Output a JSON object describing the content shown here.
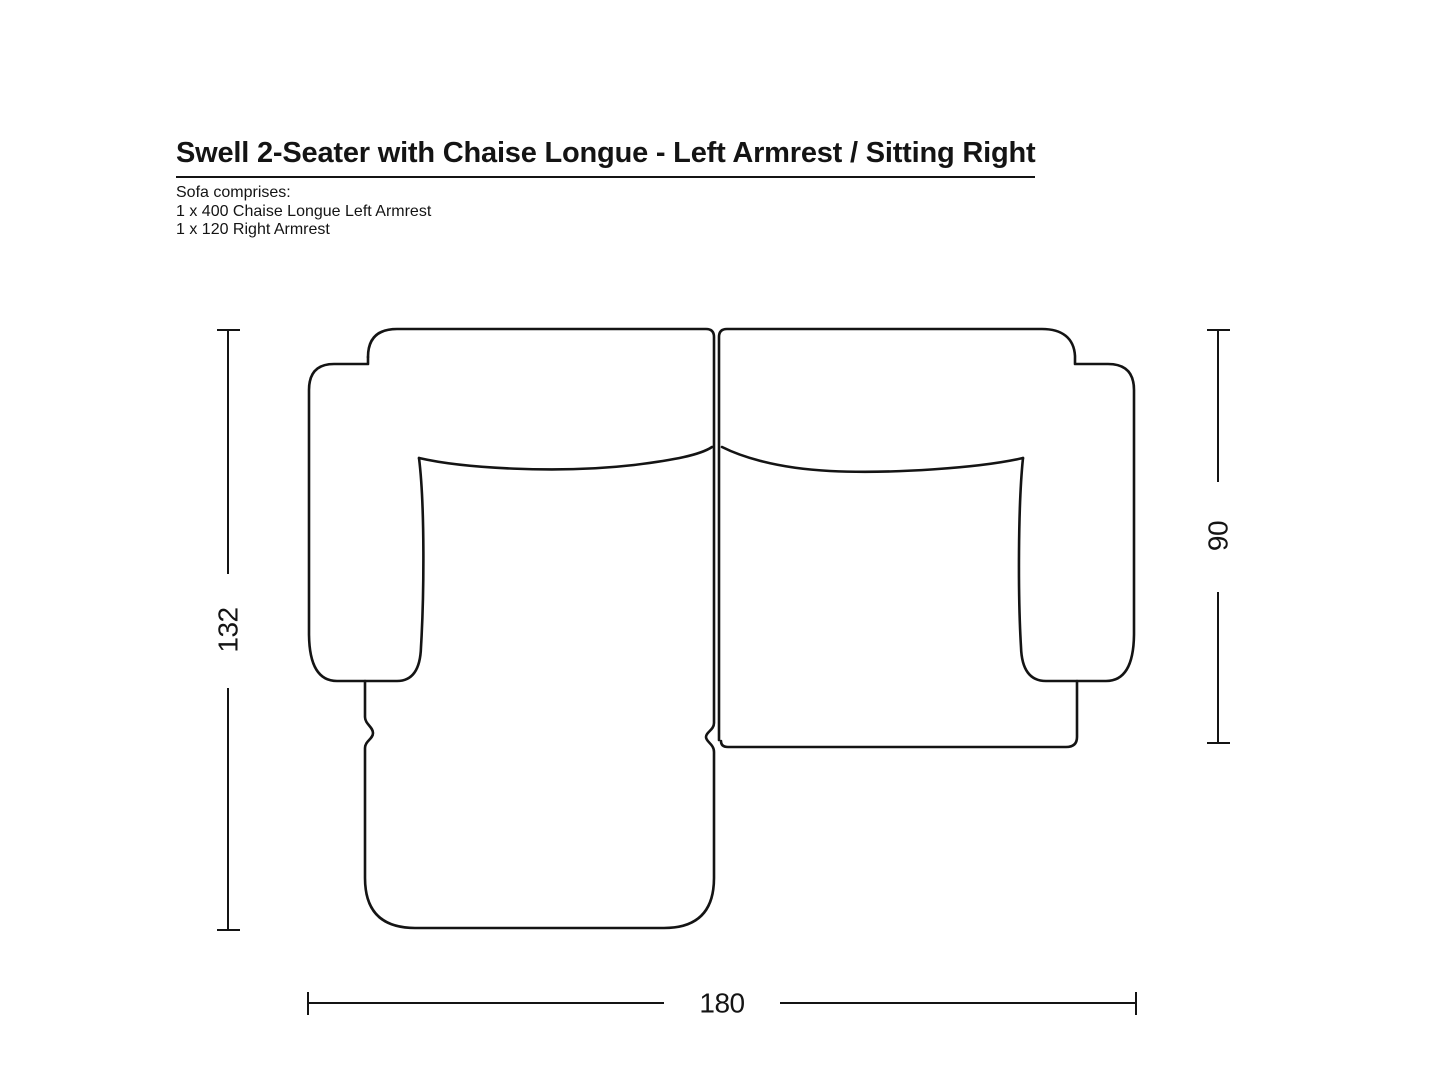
{
  "title": "Swell 2-Seater with Chaise Longue - Left Armrest / Sitting Right",
  "comprises": {
    "heading": "Sofa comprises:",
    "items": [
      "1 x 400 Chaise Longue Left Armrest",
      "1 x 120 Right Armrest"
    ]
  },
  "dimensions": {
    "total_depth": "132",
    "right_module_depth": "90",
    "total_width": "180"
  },
  "colors": {
    "line": "#141414",
    "background": "#ffffff"
  }
}
